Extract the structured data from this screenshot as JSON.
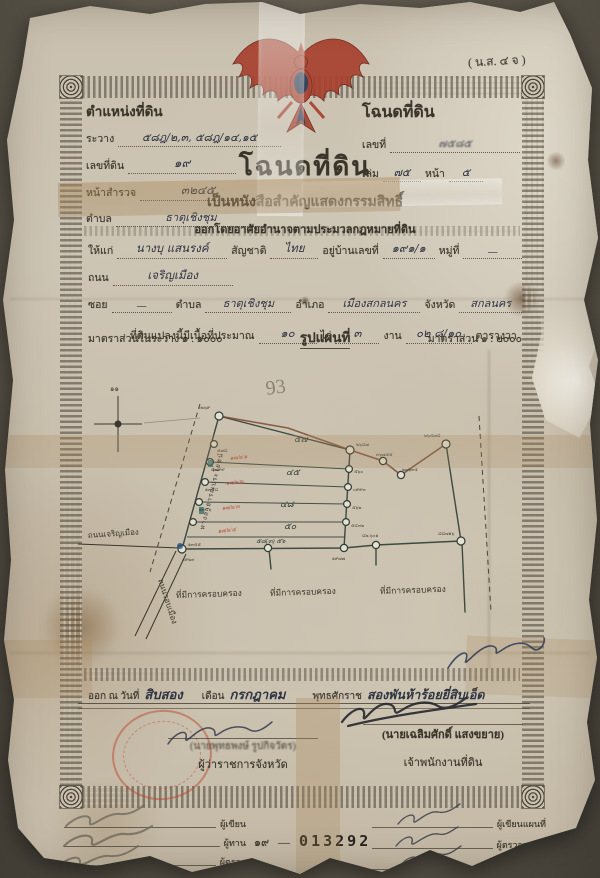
{
  "form_code": "( น.ส. ๔ จ )",
  "header_left": {
    "title": "ตำแหน่งที่ดิน",
    "ravang_label": "ระวาง",
    "ravang_value": "๕๘ฎ/๒,๓, ๕๘ฎ/๑๔,๑๕",
    "land_no_label": "เลขที่ดิน",
    "land_no_value": "๑๙",
    "survey_label": "หน้าสำรวจ",
    "survey_value": "๓๒๔๕",
    "tambon_label": "ตำบล",
    "tambon_value": "ธาตุเชิงชุม"
  },
  "header_right": {
    "title": "โฉนดที่ดิน",
    "no_label": "เลขที่",
    "no_value": "๗๕๘๕",
    "book_label": "เล่ม",
    "book_value": "๗๕",
    "page_label": "หน้า",
    "page_value": "๕"
  },
  "title_block": {
    "main": "โฉนดที่ดิน",
    "sub": "เป็นหนังสือสำคัญแสดงกรรมสิทธิ์",
    "authority": "ออกโดยอาศัยอำนาจตามประมวลกฎหมายที่ดิน"
  },
  "owner": {
    "give_label": "ให้แก่",
    "name": "นางบุ แสนรงค์",
    "nationality_label": "สัญชาติ",
    "nationality": "ไทย",
    "address_label": "อยู่บ้านเลขที่",
    "address": "๑๙๑/๑",
    "moo_label": "หมู่ที่",
    "moo": "—",
    "road_label": "ถนน",
    "road": "เจริญเมือง",
    "soi_label": "ซอย",
    "soi": "—",
    "tambon_label": "ตำบล",
    "tambon": "ธาตุเชิงชุม",
    "amphoe_label": "อำเภอ",
    "amphoe": "เมืองสกลนคร",
    "province_label": "จังหวัด",
    "province": "สกลนคร",
    "area_label": "ที่ดินแปลงนี้มีเนื้อที่ประมาณ",
    "rai": "๑๐",
    "rai_label": "ไร่",
    "ngan": "๓",
    "ngan_label": "งาน",
    "wa": "๐๒ ๘/๑๐",
    "wa_label": "ตารางวา"
  },
  "scale": {
    "in_ravang": "มาตราส่วนในระวาง ๑ : ๑๐๐๐",
    "map_title": "รูปแผนที่",
    "map_scale": "มาตราส่วน ๑ : ๒๐๐๐"
  },
  "map": {
    "pencil_note": "93",
    "compass_note": "๑๑",
    "edge_label": "ทางสาธารณประโยชน์",
    "road_left": "ถนนเจริญเมือง",
    "road_diagonal": "ถนนรอบเมือง",
    "possession_labels": [
      "ที่มีการครอบครอง",
      "ที่มีการครอบครอง",
      "ที่มีการครอบครอง"
    ],
    "parcels": [
      "๕๗",
      "๔๕",
      "๔๘",
      "๕๐"
    ],
    "bottom_note": "๕๘(๓) ๕๖",
    "red_notes": [
      "๑๗๖/๑",
      "๑๗๖/๒",
      "๑๗๖/๓",
      "๑๗๖/๔"
    ],
    "vertices": {
      "tl": "๐๒๖๙",
      "tr": "๒๖๘๗",
      "z1": "๓๖๗๕๕",
      "z2": "๒๓๖๓๕",
      "far": "๒๖๔๗๘",
      "l1": "๕๗๘",
      "l2": "๕๗๙๙",
      "l3": "๑๓๔๘",
      "l4": "๑๓๔๖",
      "bl": "๑๓๕๕",
      "bl2": "๐๙๒๓",
      "r1": "๕๖๐",
      "r2": "๐๙๙๓",
      "r3": "๕๖๒",
      "r4": "๕๔๓๒",
      "br": "๑๙๗๗",
      "b1": "๘๒.๖๐๑",
      "b2": "๘๘๗๑๖"
    }
  },
  "issue": {
    "issued_label": "ออก ณ วันที่",
    "day": "สิบสอง",
    "month_label": "เดือน",
    "month": "กรกฎาคม",
    "era_label": "พุทธศักราช",
    "year": "สองพันห้าร้อยยี่สิบเอ็ด"
  },
  "signers": {
    "governor_name": "(นายพุทธพงษ์ รูปกิจวัตร)",
    "governor_title": "ผู้ว่าราชการจังหวัด",
    "officer_name": "(นายเฉลิมศักดิ์ แสงขยาย)",
    "officer_title": "เจ้าพนักงานที่ดิน"
  },
  "footer": {
    "left_roles": [
      "ผู้เขียน",
      "ผู้ทาน",
      "ผู้ตรวจ"
    ],
    "right_roles": [
      "ผู้เขียนแผนที่",
      "ผู้ตรวจแผนที่",
      "หัวหน้าการ"
    ],
    "serial_thai": "๑๙",
    "serial_sep": "—",
    "serial_number": "013292"
  },
  "colors": {
    "garuda_red": "#a8402e",
    "garuda_navy": "#2a3a58",
    "stamp_red": "#bc4630",
    "ink": "#2e3442",
    "map_ink": "#2e3d36"
  }
}
